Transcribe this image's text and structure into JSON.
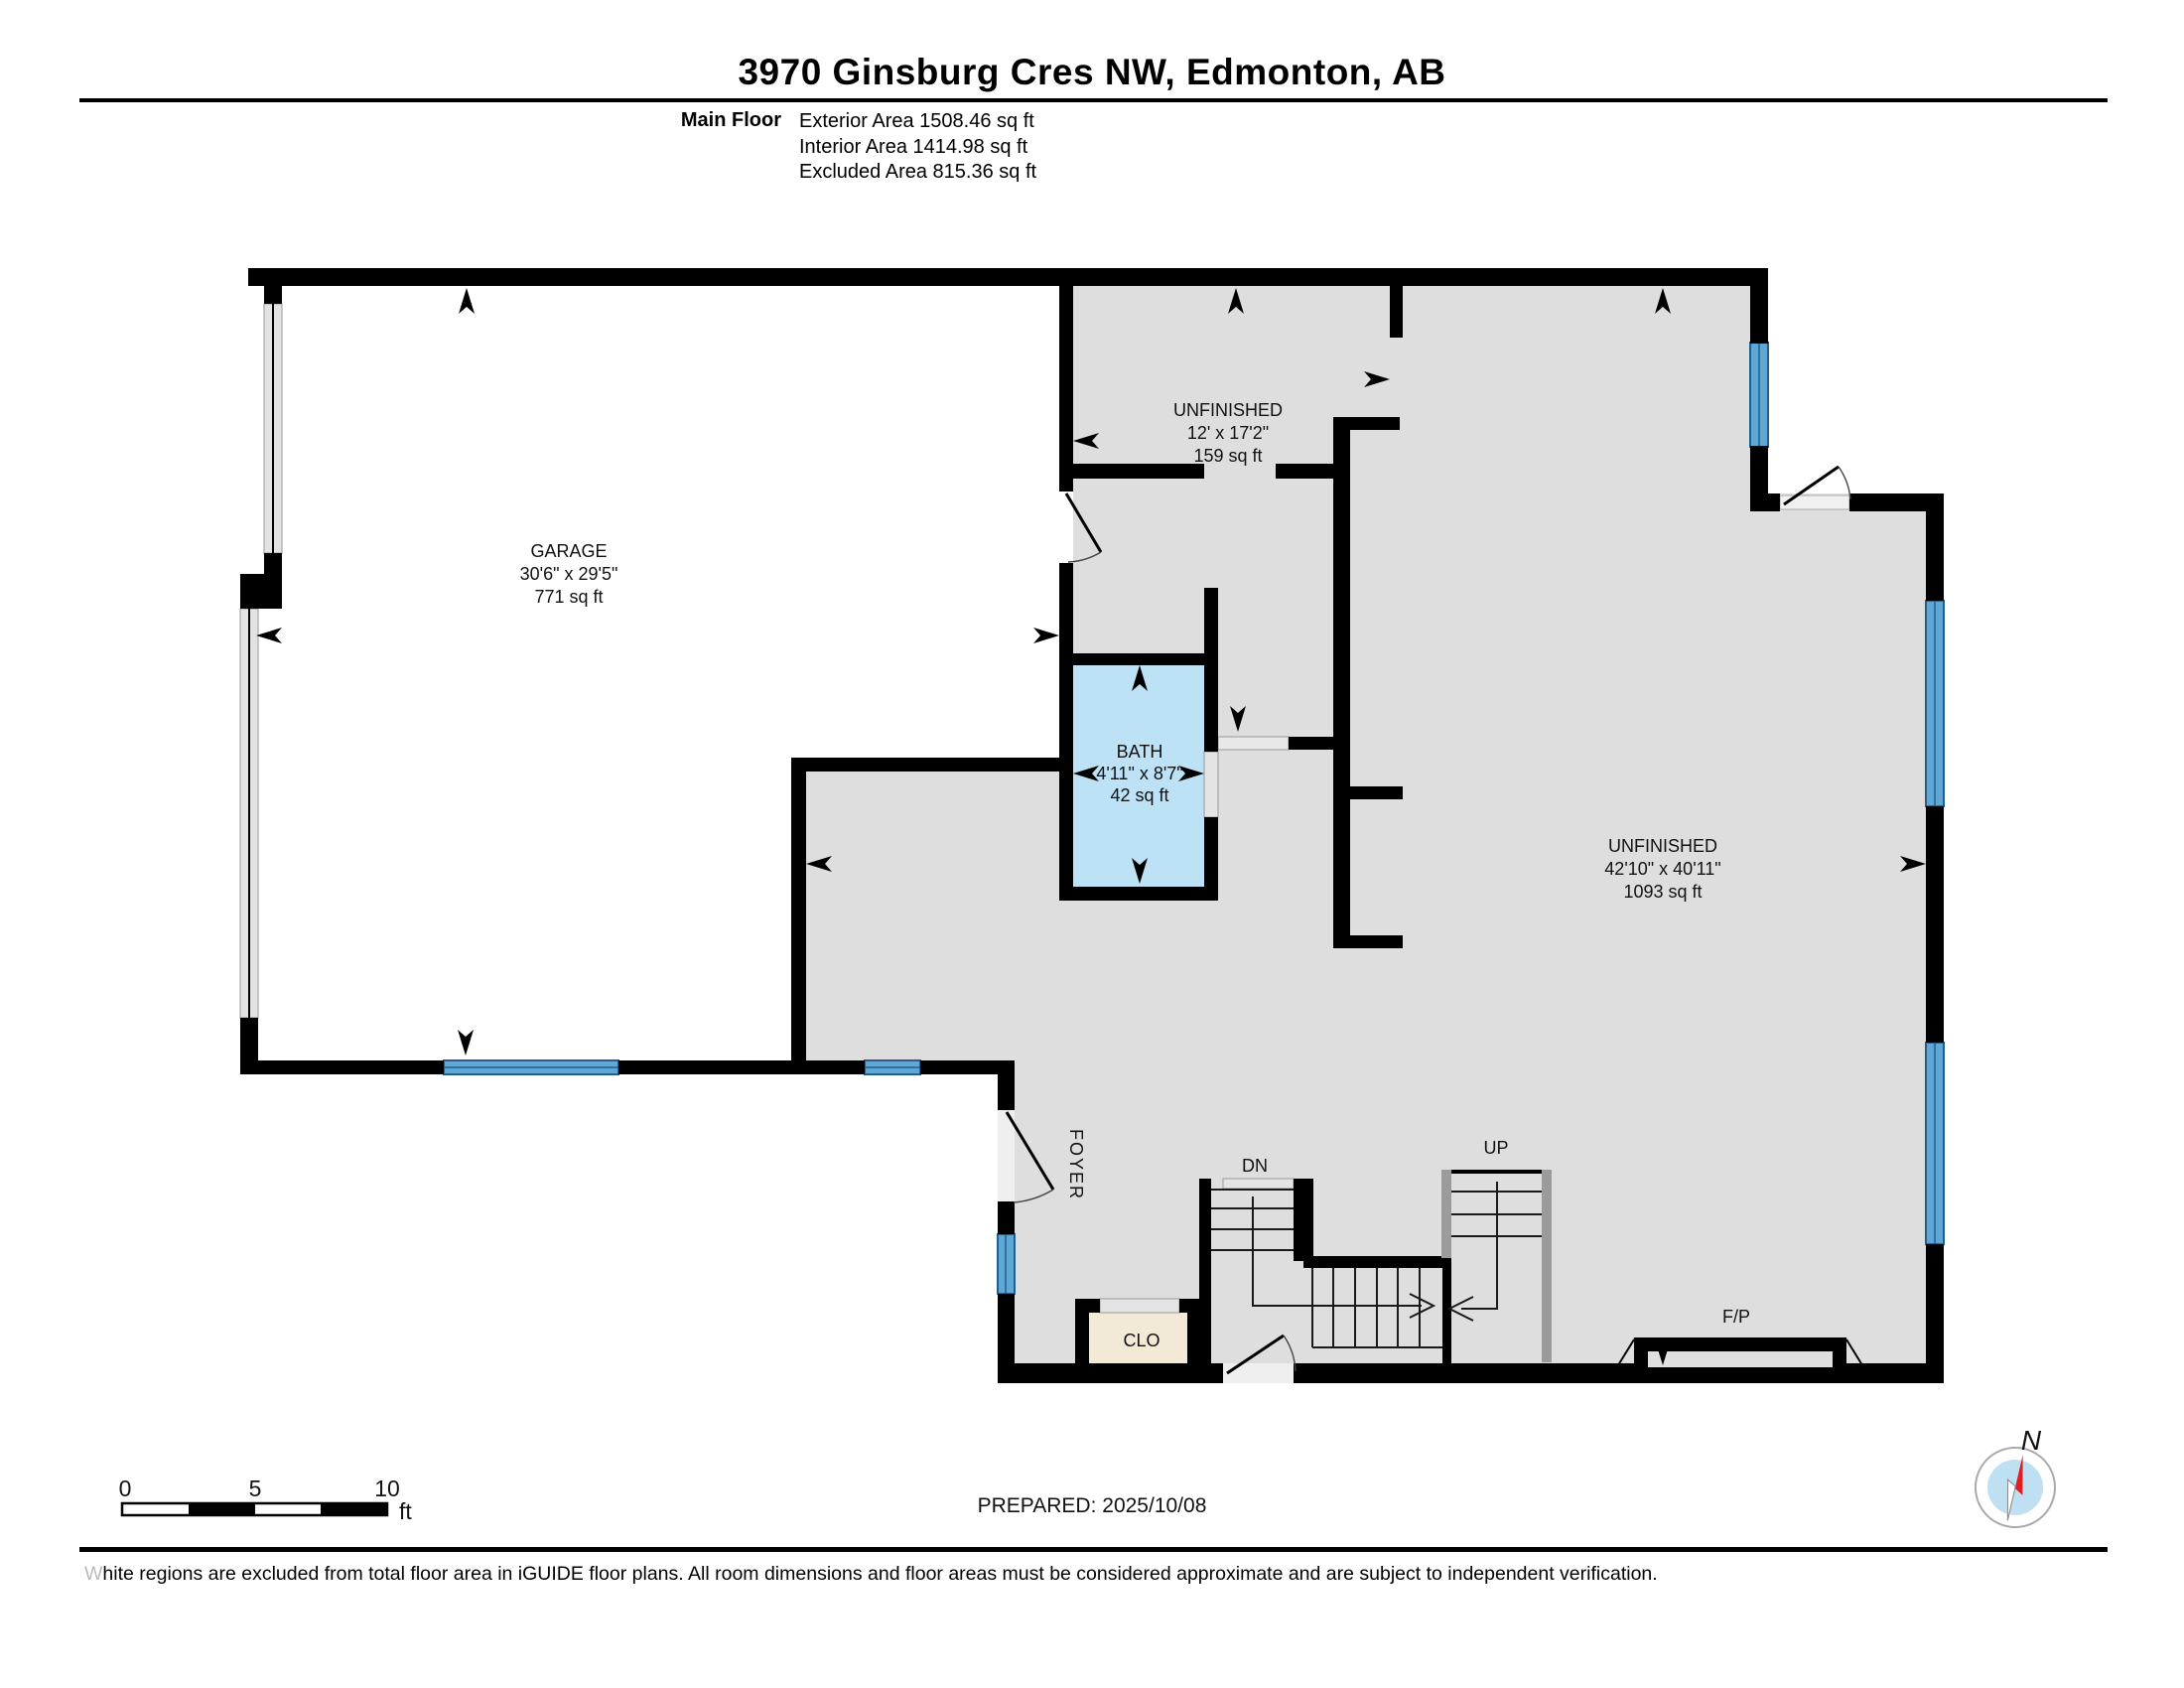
{
  "title": "3970 Ginsburg Cres NW, Edmonton, AB",
  "floor_summary": {
    "floor_label": "Main Floor",
    "exterior": "Exterior Area 1508.46 sq ft",
    "interior": "Interior Area 1414.98 sq ft",
    "excluded": "Excluded Area 815.36 sq ft"
  },
  "rooms": {
    "garage": {
      "name": "GARAGE",
      "dims": "30'6\" x 29'5\"",
      "area": "771 sq ft"
    },
    "unfinished_upper": {
      "name": "UNFINISHED",
      "dims": "12' x 17'2\"",
      "area": "159 sq ft"
    },
    "bath": {
      "name": "BATH",
      "dims": "4'11\" x 8'7\"",
      "area": "42 sq ft"
    },
    "unfinished_main": {
      "name": "UNFINISHED",
      "dims": "42'10\" x 40'11\"",
      "area": "1093 sq ft"
    },
    "foyer": {
      "name": "FOYER"
    },
    "closet": {
      "name": "CLO"
    }
  },
  "stairs": {
    "down_label": "DN",
    "up_label": "UP"
  },
  "fireplace_label": "F/P",
  "compass": {
    "north_label": "N"
  },
  "scale_bar": {
    "tick0": "0",
    "tick5": "5",
    "tick10": "10",
    "unit": "ft"
  },
  "prepared": "PREPARED: 2025/10/08",
  "footer_text": "White regions are excluded from total floor area in iGUIDE floor plans. All room dimensions and floor areas must be considered approximate and are subject to independent verification.",
  "colors": {
    "wall": "#000000",
    "interior_fill": "#dedede",
    "excluded_fill": "#ffffff",
    "bath_fill": "#bde2f6",
    "closet_fill": "#f3e9d7",
    "window_fill": "#5fa8d6",
    "window_edge": "#245e8c",
    "compass_needle_red": "#e02020",
    "compass_inner": "#bfdff2"
  }
}
